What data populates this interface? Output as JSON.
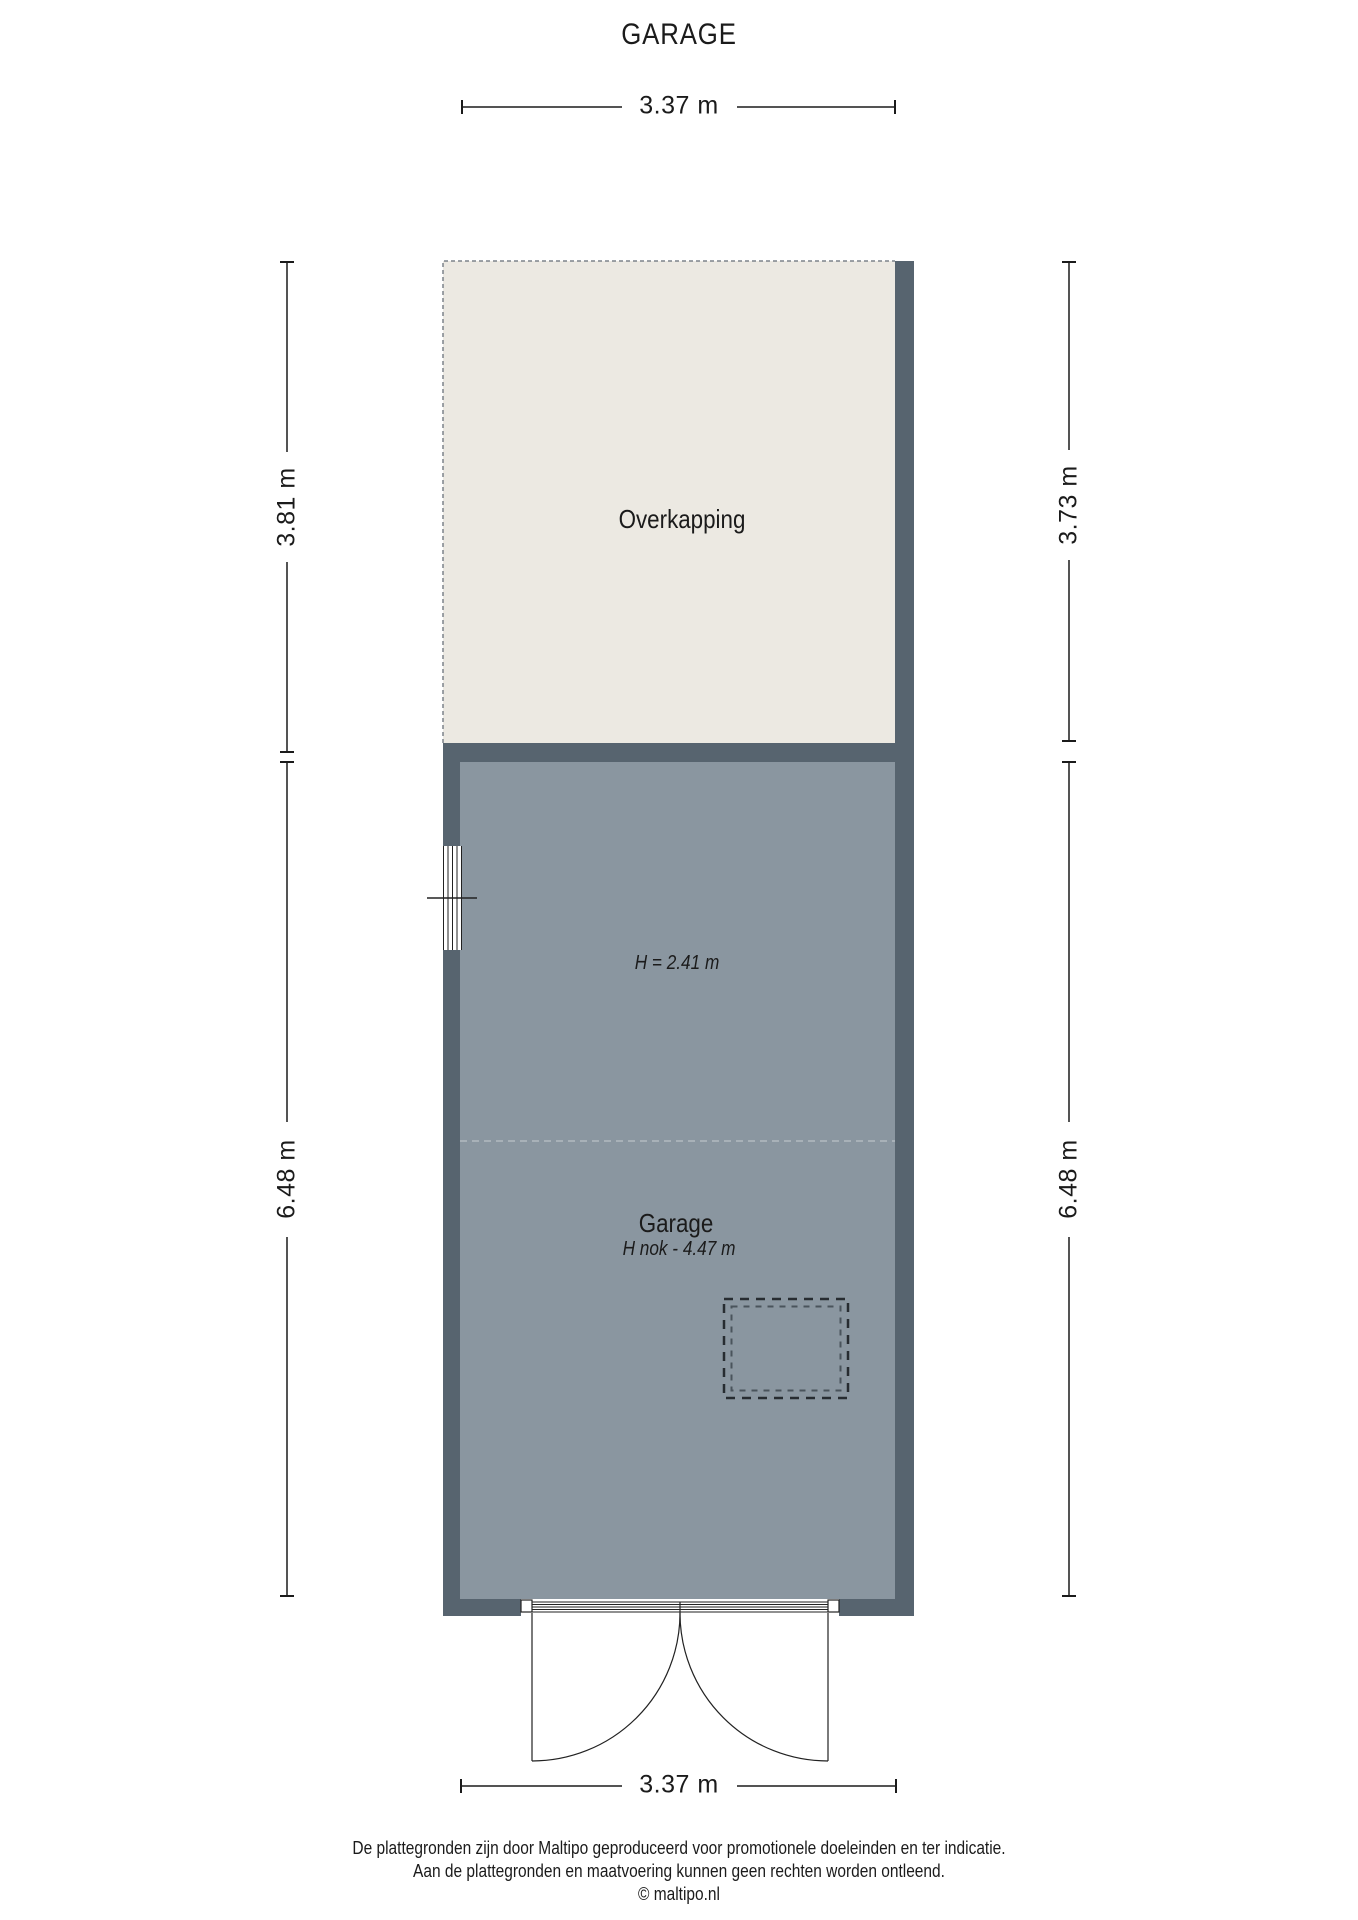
{
  "title": "GARAGE",
  "dimensions": {
    "top": "3.37 m",
    "left_upper": "3.81 m",
    "right_upper": "3.73 m",
    "left_lower": "6.48 m",
    "right_lower": "6.48 m",
    "bottom": "3.37 m"
  },
  "rooms": {
    "overkapping": {
      "label": "Overkapping"
    },
    "garage": {
      "label": "Garage",
      "ceiling_note": "H = 2.41 m",
      "ridge_note": "H nok - 4.47 m"
    }
  },
  "footer": {
    "line1": "De plattegronden zijn door Maltipo geproduceerd voor promotionele doeleinden en ter indicatie.",
    "line2": "Aan de plattegronden en maatvoering kunnen geen rechten worden ontleend.",
    "line3": "© maltipo.nl"
  },
  "colors": {
    "wall": "#57646F",
    "floor": "#8A96A0",
    "canopy": "#ECE9E2",
    "text": "#1B1B1B",
    "dash": "#7D838A",
    "divider": "#B2BAC0",
    "line": "#222222"
  }
}
